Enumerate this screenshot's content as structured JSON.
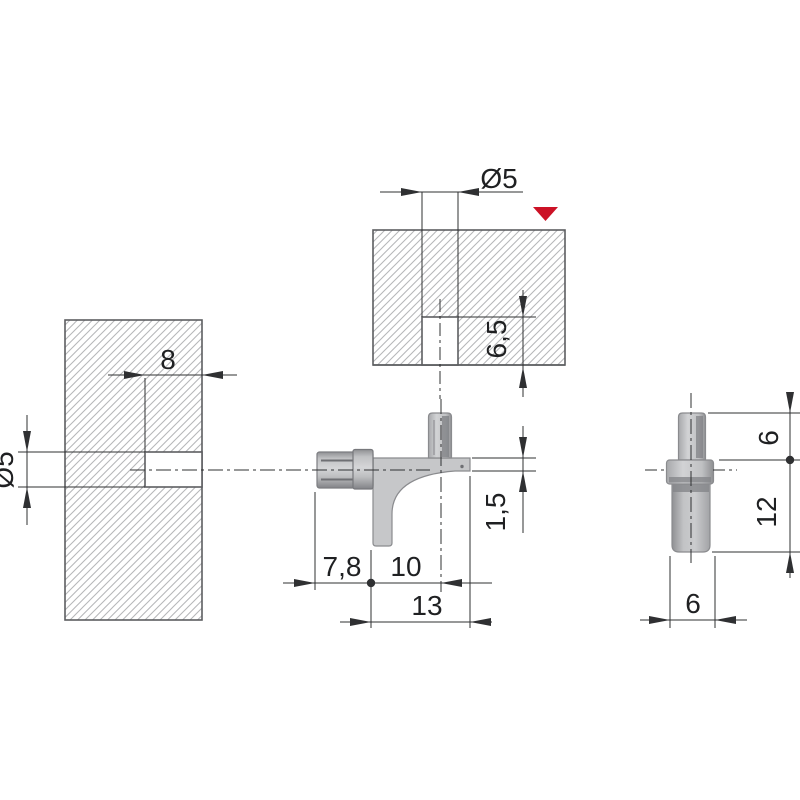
{
  "title": "Shelf support pin - dimensioned technical drawing",
  "colors": {
    "marker_red": "#cc1226",
    "part_gray": "#c6c7c9",
    "line_dark": "#2f3032",
    "hatch_gray": "#b5b6b8"
  },
  "views": {
    "left_panel_section": {
      "hole_depth": "8",
      "hole_diameter": "Ø5"
    },
    "top_panel_section": {
      "hole_diameter": "Ø5",
      "hole_depth": "6,5"
    },
    "pin_side_view": {
      "pin_length": "7,8",
      "support_length": "10",
      "overall_length": "13",
      "arm_thickness": "1,5"
    },
    "pin_front_view": {
      "upper_height": "6",
      "lower_height": "12",
      "width": "6"
    }
  }
}
